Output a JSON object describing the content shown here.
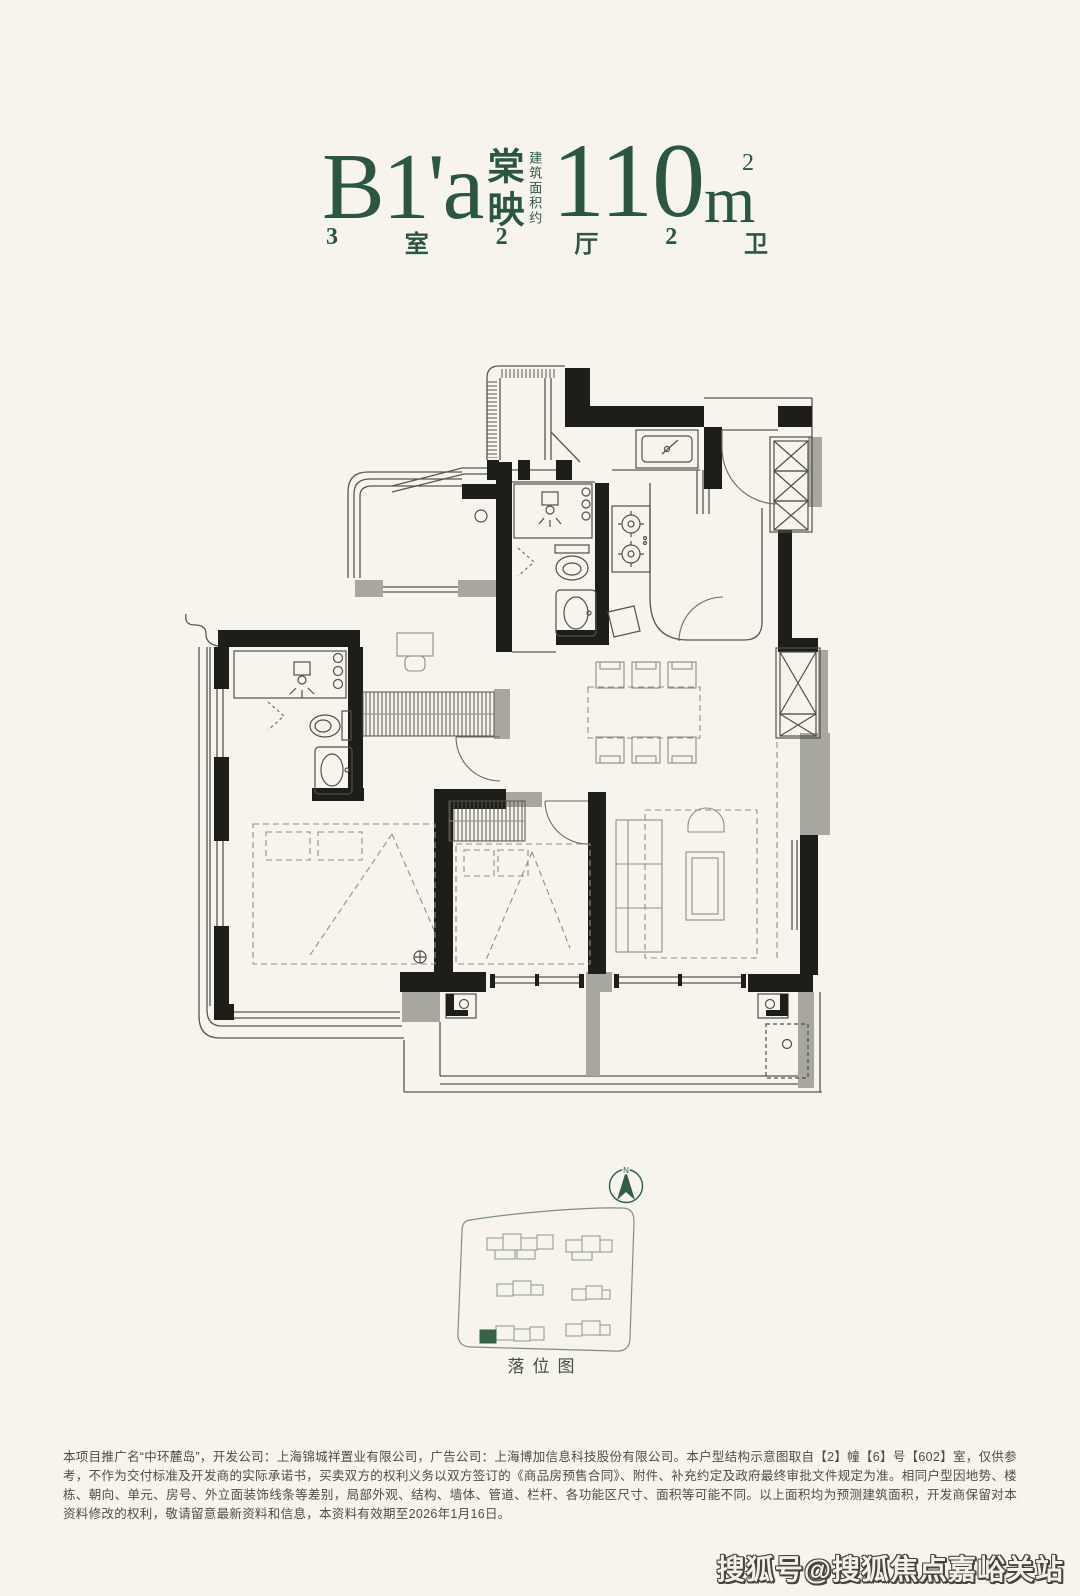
{
  "header": {
    "unit_code": "B1'a",
    "unit_name": "棠映",
    "area_label": "建筑面积约",
    "area_value": "110",
    "area_unit": "m",
    "area_unit_sup": "2",
    "spec": [
      "3",
      "室",
      "2",
      "厅",
      "2",
      "卫"
    ],
    "accent_color": "#2b573f"
  },
  "floorplan": {
    "wall_color": "#1d1d1a",
    "gray_wall_color": "#a7a7a0",
    "line_color": "#57574f"
  },
  "siteplan": {
    "label": "落位图",
    "north": "N",
    "outline_color": "#7f8f83",
    "highlight_color": "#376449"
  },
  "disclaimer": {
    "text": "本项目推广名“中环麓岛”，开发公司：上海锦城祥置业有限公司，广告公司：上海博加信息科技股份有限公司。本户型结构示意图取自【2】幢【6】号【602】室，仅供参考，不作为交付标准及开发商的实际承诺书，买卖双方的权利义务以双方签订的《商品房预售合同》、附件、补充约定及政府最终审批文件规定为准。相同户型因地势、楼栋、朝向、单元、房号、外立面装饰线条等差别，局部外观、结构、墙体、管道、栏杆、各功能区尺寸、面积等可能不同。以上面积均为预测建筑面积，开发商保留对本资料修改的权利，敬请留意最新资料和信息，本资料有效期至2026年1月16日。"
  },
  "watermark": {
    "text": "搜狐号@搜狐焦点嘉峪关站"
  }
}
